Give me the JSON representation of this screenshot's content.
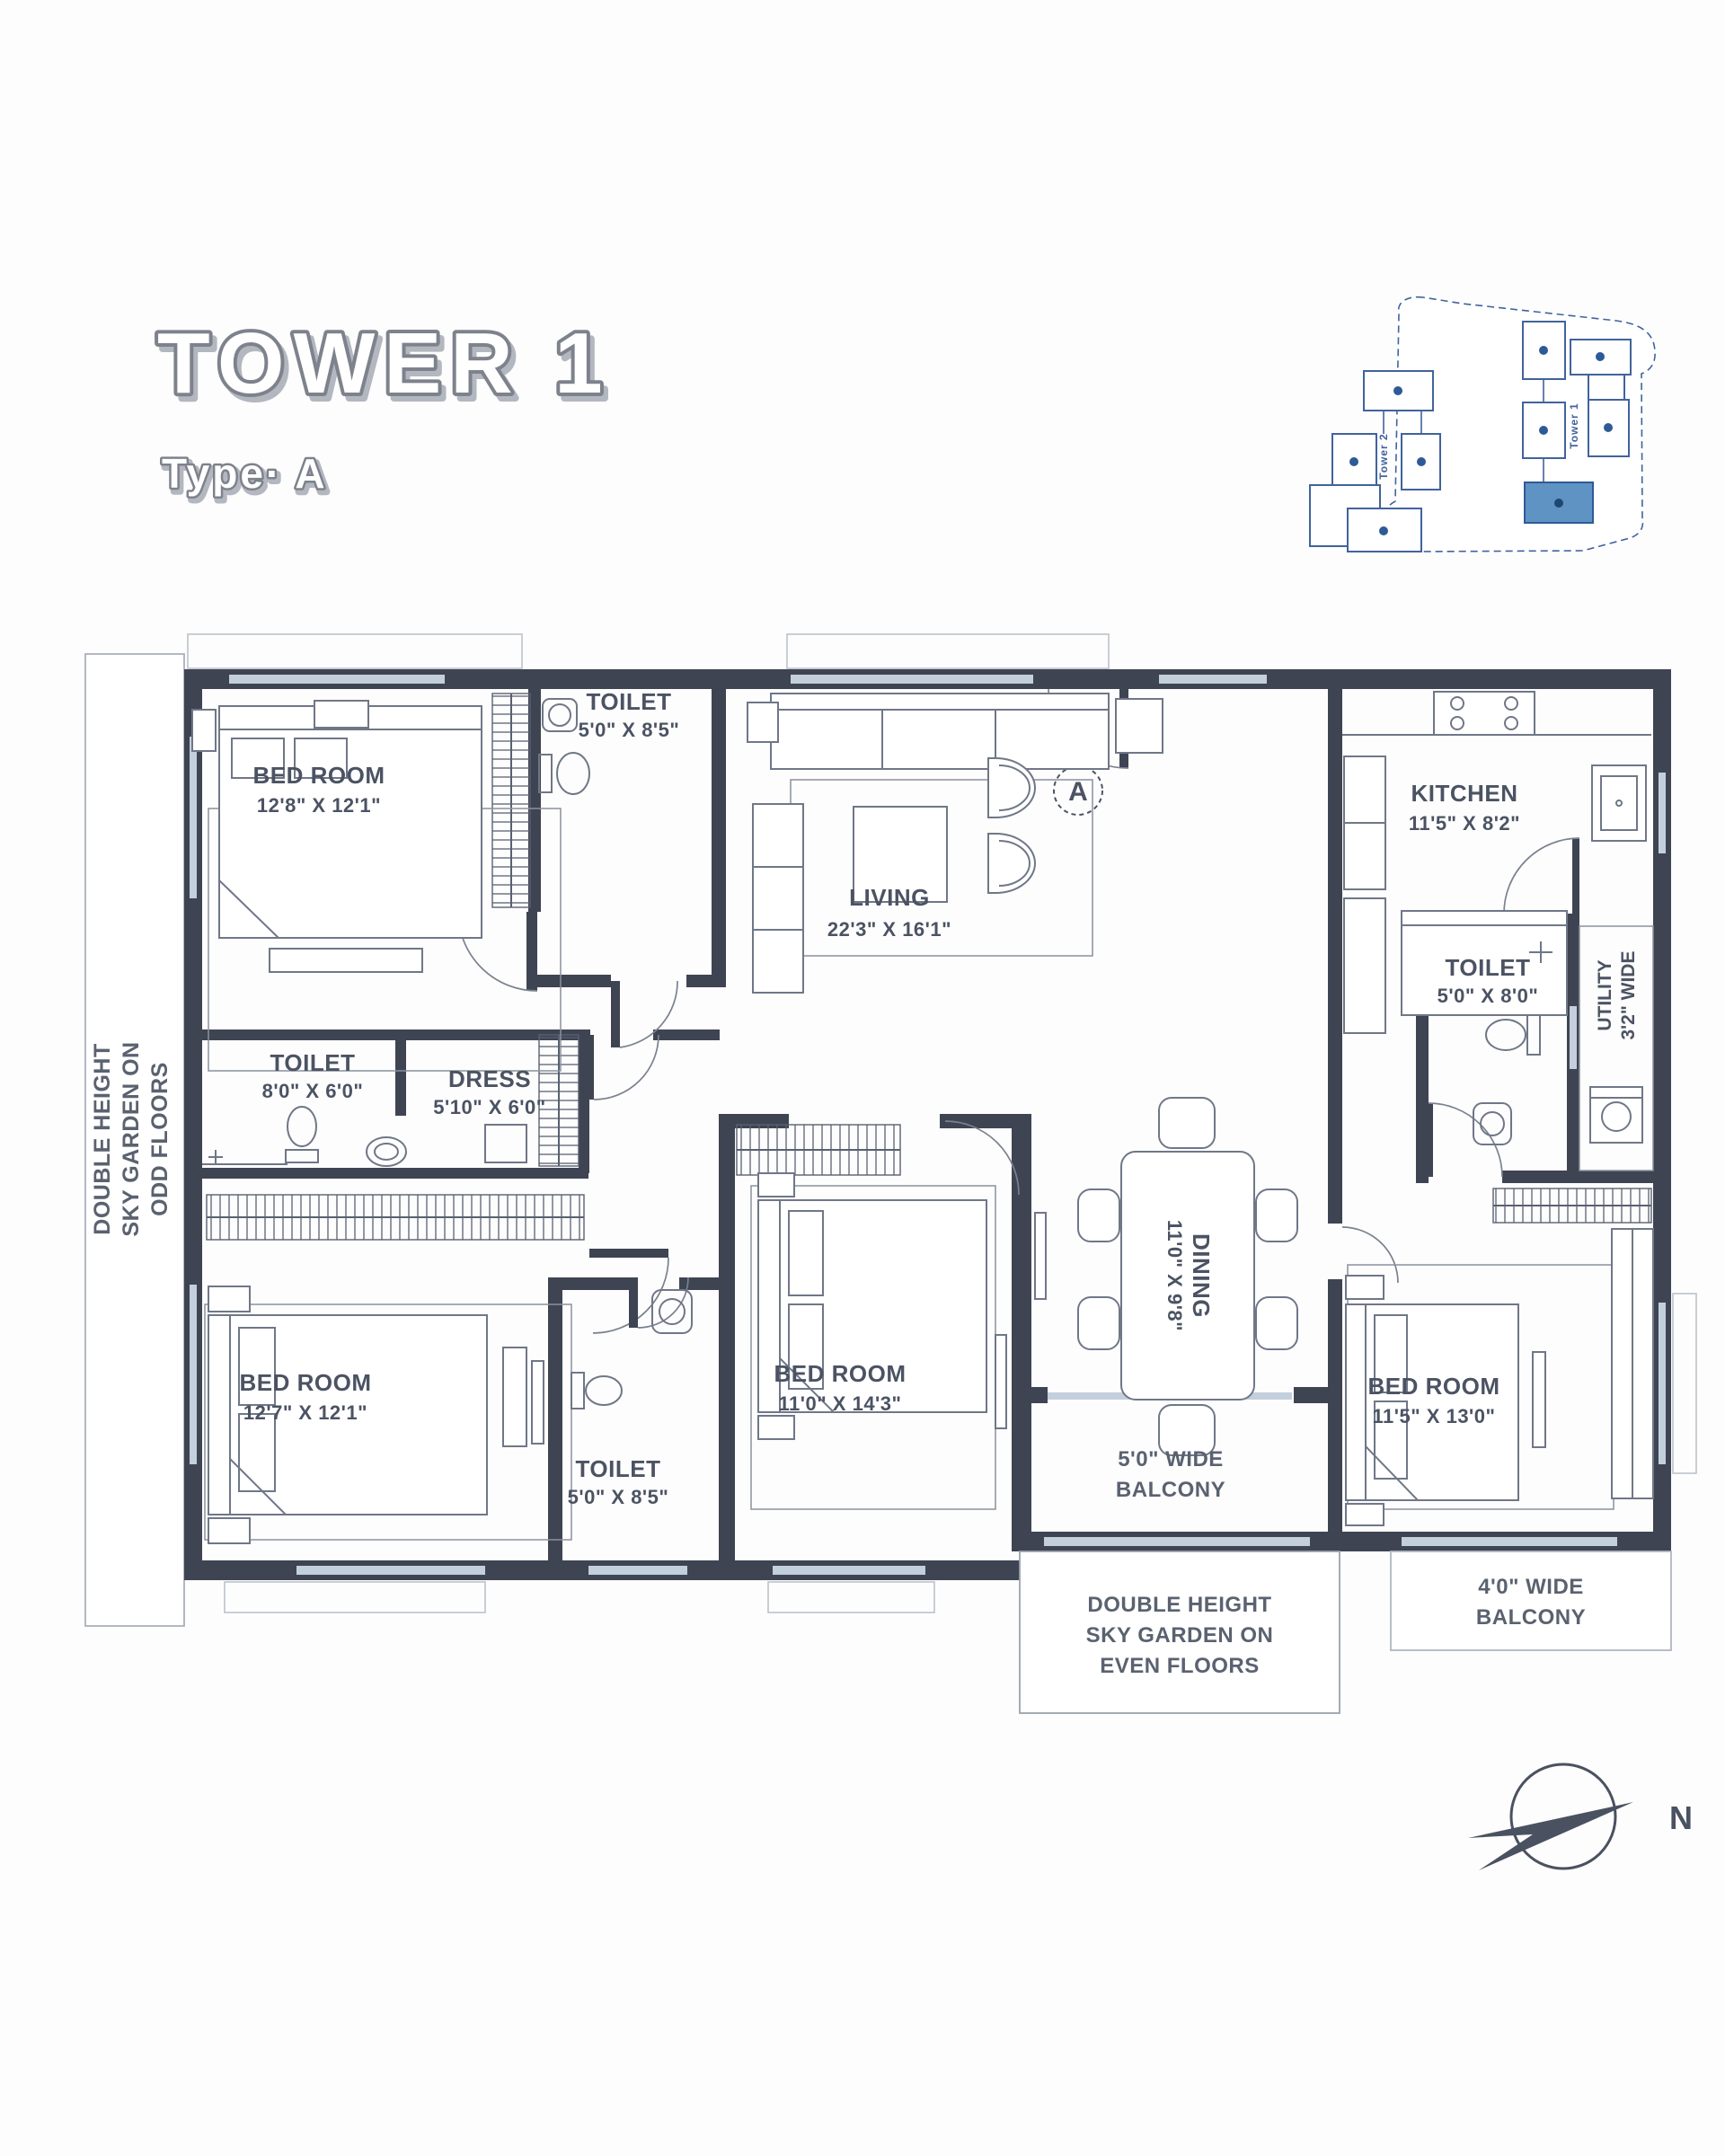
{
  "title": {
    "main": "TOWER 1",
    "subtitle": "Type· A"
  },
  "locator": {
    "tower1": "Tower 1",
    "tower2": "Tower 2"
  },
  "entrance_marker": "A",
  "compass_north": "N",
  "rooms": {
    "bedroom_top_left": {
      "name": "BED ROOM",
      "dims": "12'8\" X 12'1\""
    },
    "toilet_top": {
      "name": "TOILET",
      "dims": "5'0\" X 8'5\""
    },
    "living": {
      "name": "LIVING",
      "dims": "22'3\" X 16'1\""
    },
    "kitchen": {
      "name": "KITCHEN",
      "dims": "11'5\" X 8'2\""
    },
    "toilet_kitchen": {
      "name": "TOILET",
      "dims": "5'0\" X 8'0\""
    },
    "utility": {
      "name": "UTILITY",
      "dims": "3'2\" WIDE"
    },
    "toilet_master": {
      "name": "TOILET",
      "dims": "8'0\" X 6'0\""
    },
    "dress": {
      "name": "DRESS",
      "dims": "5'10\" X 6'0\""
    },
    "bedroom_bottom_left": {
      "name": "BED ROOM",
      "dims": "12'7\" X 12'1\""
    },
    "toilet_bottom": {
      "name": "TOILET",
      "dims": "5'0\" X 8'5\""
    },
    "bedroom_middle": {
      "name": "BED ROOM",
      "dims": "11'0\" X 14'3\""
    },
    "dining": {
      "name": "DINING",
      "dims": "11'0\" X 9'8\""
    },
    "bedroom_right": {
      "name": "BED ROOM",
      "dims": "11'5\" X 13'0\""
    }
  },
  "balconies": {
    "balcony_5": {
      "line1": "5'0\" WIDE",
      "line2": "BALCONY"
    },
    "balcony_4": {
      "line1": "4'0\" WIDE",
      "line2": "BALCONY"
    }
  },
  "sky_gardens": {
    "odd": {
      "line1": "DOUBLE HEIGHT",
      "line2": "SKY GARDEN ON",
      "line3": "ODD FLOORS"
    },
    "even": {
      "line1": "DOUBLE HEIGHT",
      "line2": "SKY GARDEN ON",
      "line3": "EVEN FLOORS"
    }
  },
  "colors": {
    "wall": "#3e4452",
    "window": "#c3cfdd",
    "furniture_line": "#6f7787",
    "label_text": "#4b5363",
    "title_outline": "#7d828c",
    "locator_stroke": "#41639c",
    "locator_highlight": "#5e93c4"
  }
}
